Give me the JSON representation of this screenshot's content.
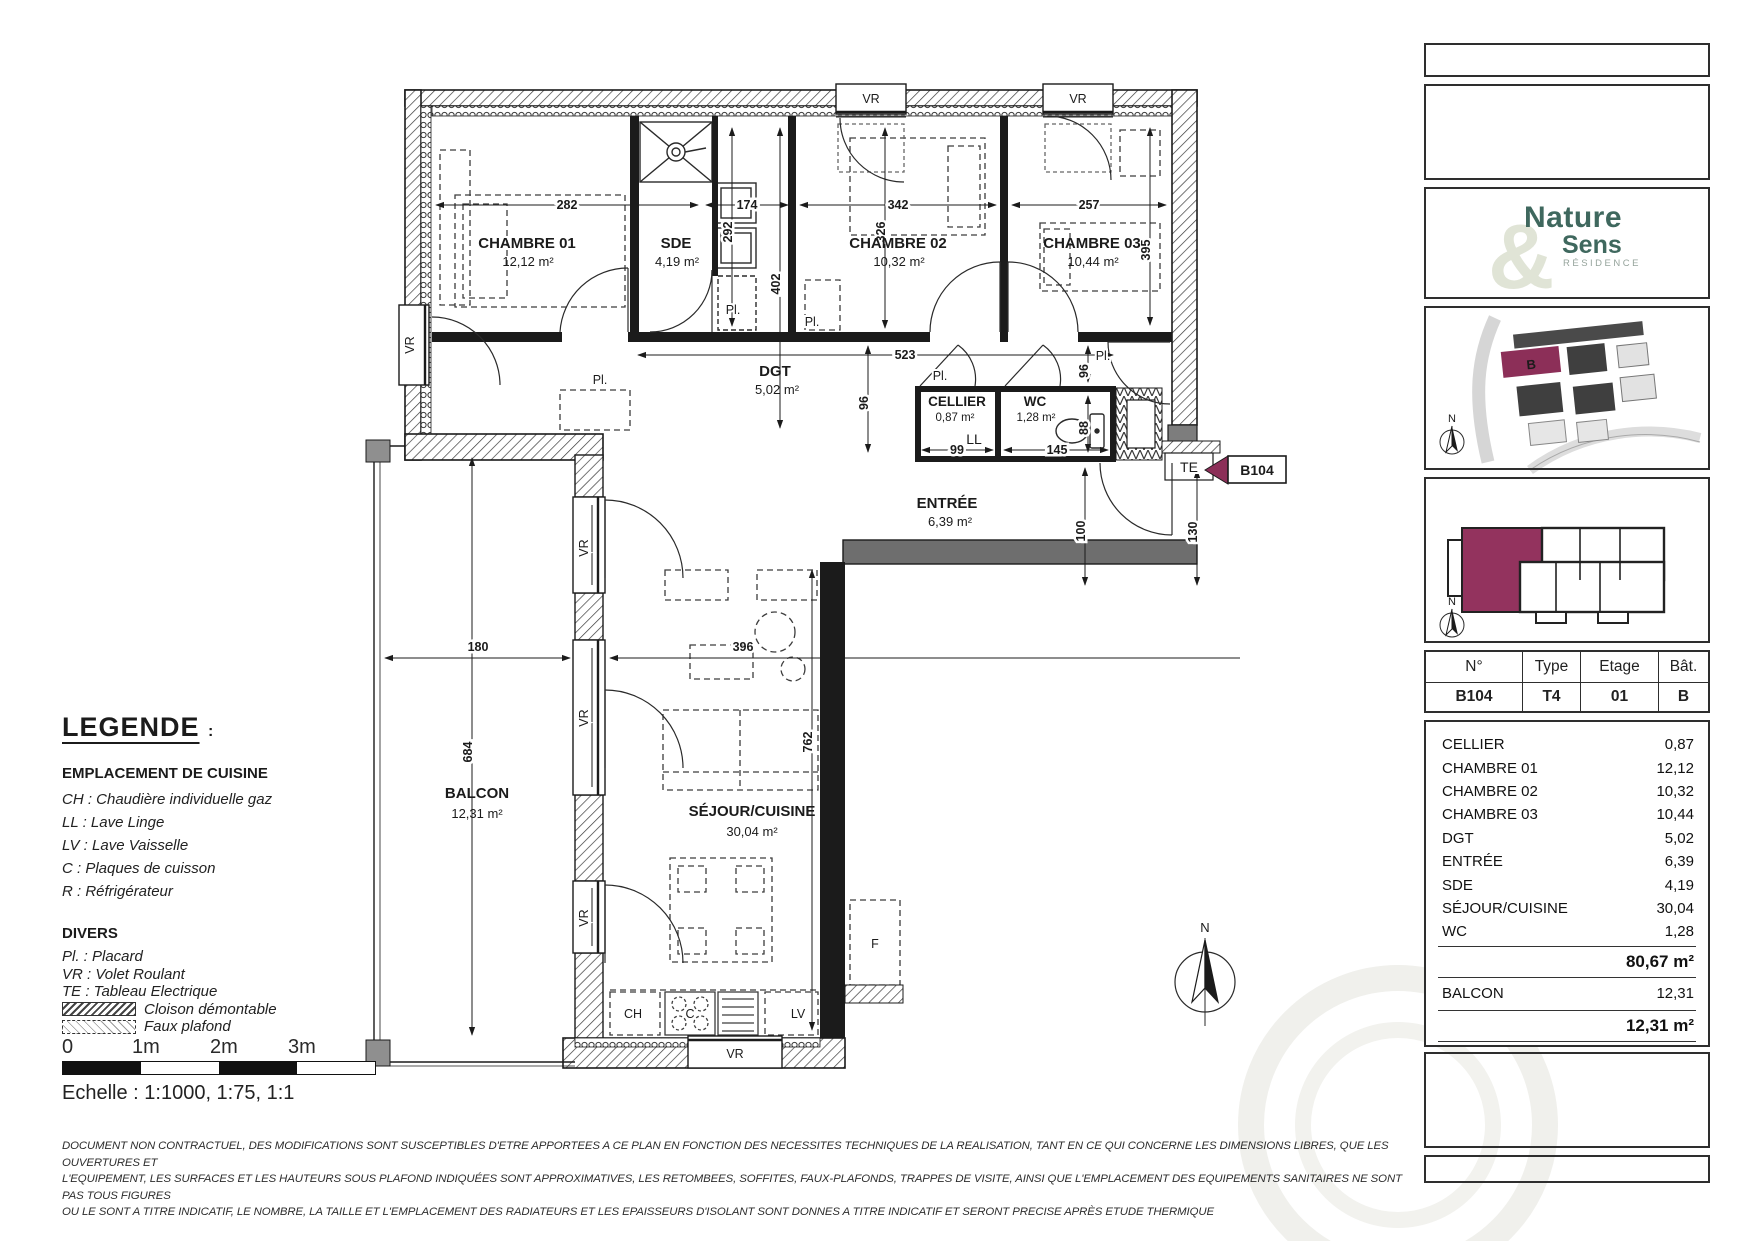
{
  "plan": {
    "rooms": [
      {
        "name": "CHAMBRE 01",
        "area": "12,12 m²"
      },
      {
        "name": "SDE",
        "area": "4,19 m²"
      },
      {
        "name": "CHAMBRE 02",
        "area": "10,32 m²"
      },
      {
        "name": "CHAMBRE 03",
        "area": "10,44 m²"
      },
      {
        "name": "DGT",
        "area": "5,02 m²"
      },
      {
        "name": "CELLIER",
        "area": "0,87 m²"
      },
      {
        "name": "WC",
        "area": "1,28 m²"
      },
      {
        "name": "ENTRÉE",
        "area": "6,39 m²"
      },
      {
        "name": "BALCON",
        "area": "12,31 m²"
      },
      {
        "name": "SÉJOUR/CUISINE",
        "area": "30,04 m²"
      }
    ],
    "dims": {
      "d282": "282",
      "d174": "174",
      "d342": "342",
      "d257": "257",
      "d402": "402",
      "d292": "292",
      "d326": "326",
      "d395": "395",
      "d523": "523",
      "d96": "96",
      "d88": "88",
      "d99": "99",
      "d145": "145",
      "d100": "100",
      "d130": "130",
      "d180": "180",
      "d396": "396",
      "d684": "684",
      "d762": "762"
    },
    "labels": {
      "vr": "VR",
      "pl": "Pl.",
      "ll": "LL",
      "te": "TE",
      "ch": "CH",
      "c": "C",
      "lv": "LV",
      "f": "F",
      "north": "N"
    },
    "unit_flag": "B104"
  },
  "legend": {
    "title": "LEGENDE",
    "colon": ":",
    "kitchen_heading": "EMPLACEMENT DE CUISINE",
    "kitchen_items": [
      "CH : Chaudière individuelle gaz",
      "LL : Lave Linge",
      "LV : Lave Vaisselle",
      "C : Plaques de cuisson",
      "R : Réfrigérateur"
    ],
    "divers_heading": "DIVERS",
    "divers_items": [
      "Pl. :  Placard",
      "VR : Volet Roulant",
      "TE : Tableau Electrique"
    ],
    "swatch_items": [
      "Cloison démontable",
      "Faux plafond"
    ],
    "scale_ticks": [
      "0",
      "1m",
      "2m",
      "3m"
    ],
    "scale_text": "Echelle : 1:1000, 1:75, 1:1"
  },
  "disclaimer": {
    "line1": "DOCUMENT NON CONTRACTUEL, DES MODIFICATIONS SONT SUSCEPTIBLES D'ETRE APPORTEES A CE PLAN EN FONCTION DES NECESSITES TECHNIQUES DE LA REALISATION, TANT EN CE QUI CONCERNE LES DIMENSIONS LIBRES, QUE LES OUVERTURES ET",
    "line2": "L'EQUIPEMENT, LES SURFACES ET LES HAUTEURS SOUS PLAFOND INDIQUÉES SONT APPROXIMATIVES, LES RETOMBEES, SOFFITES, FAUX-PLAFONDS, TRAPPES DE VISITE, AINSI QUE L'EMPLACEMENT DES EQUIPEMENTS SANITAIRES NE SONT PAS TOUS FIGURES",
    "line3": "OU LE SONT A TITRE INDICATIF, LE NOMBRE, LA TAILLE ET L'EMPLACEMENT DES RADIATEURS ET LES EPAISSEURS D'ISOLANT SONT DONNES A TITRE INDICATIF ET SERONT PRECISE APRÈS ETUDE THERMIQUE"
  },
  "sidebar": {
    "logo": {
      "line1": "Nature",
      "amp": "&",
      "line2": "Sens",
      "line3": "RÉSIDENCE"
    },
    "site_building_label": "B",
    "unit_table": {
      "headers": [
        "N°",
        "Type",
        "Etage",
        "Bât."
      ],
      "values": [
        "B104",
        "T4",
        "01",
        "B"
      ]
    },
    "areas": {
      "rows": [
        {
          "label": "CELLIER",
          "value": "0,87"
        },
        {
          "label": "CHAMBRE 01",
          "value": "12,12"
        },
        {
          "label": "CHAMBRE 02",
          "value": "10,32"
        },
        {
          "label": "CHAMBRE 03",
          "value": "10,44"
        },
        {
          "label": "DGT",
          "value": "5,02"
        },
        {
          "label": "ENTRÉE",
          "value": "6,39"
        },
        {
          "label": "SDE",
          "value": "4,19"
        },
        {
          "label": "SÉJOUR/CUISINE",
          "value": "30,04"
        },
        {
          "label": "WC",
          "value": "1,28"
        }
      ],
      "total": "80,67 m²",
      "balcon_label": "BALCON",
      "balcon_value": "12,31",
      "balcon_total": "12,31 m²"
    }
  },
  "colors": {
    "accent": "#8C2F58",
    "logo_green": "#3F685E",
    "logo_light": "#E0E4D6"
  }
}
